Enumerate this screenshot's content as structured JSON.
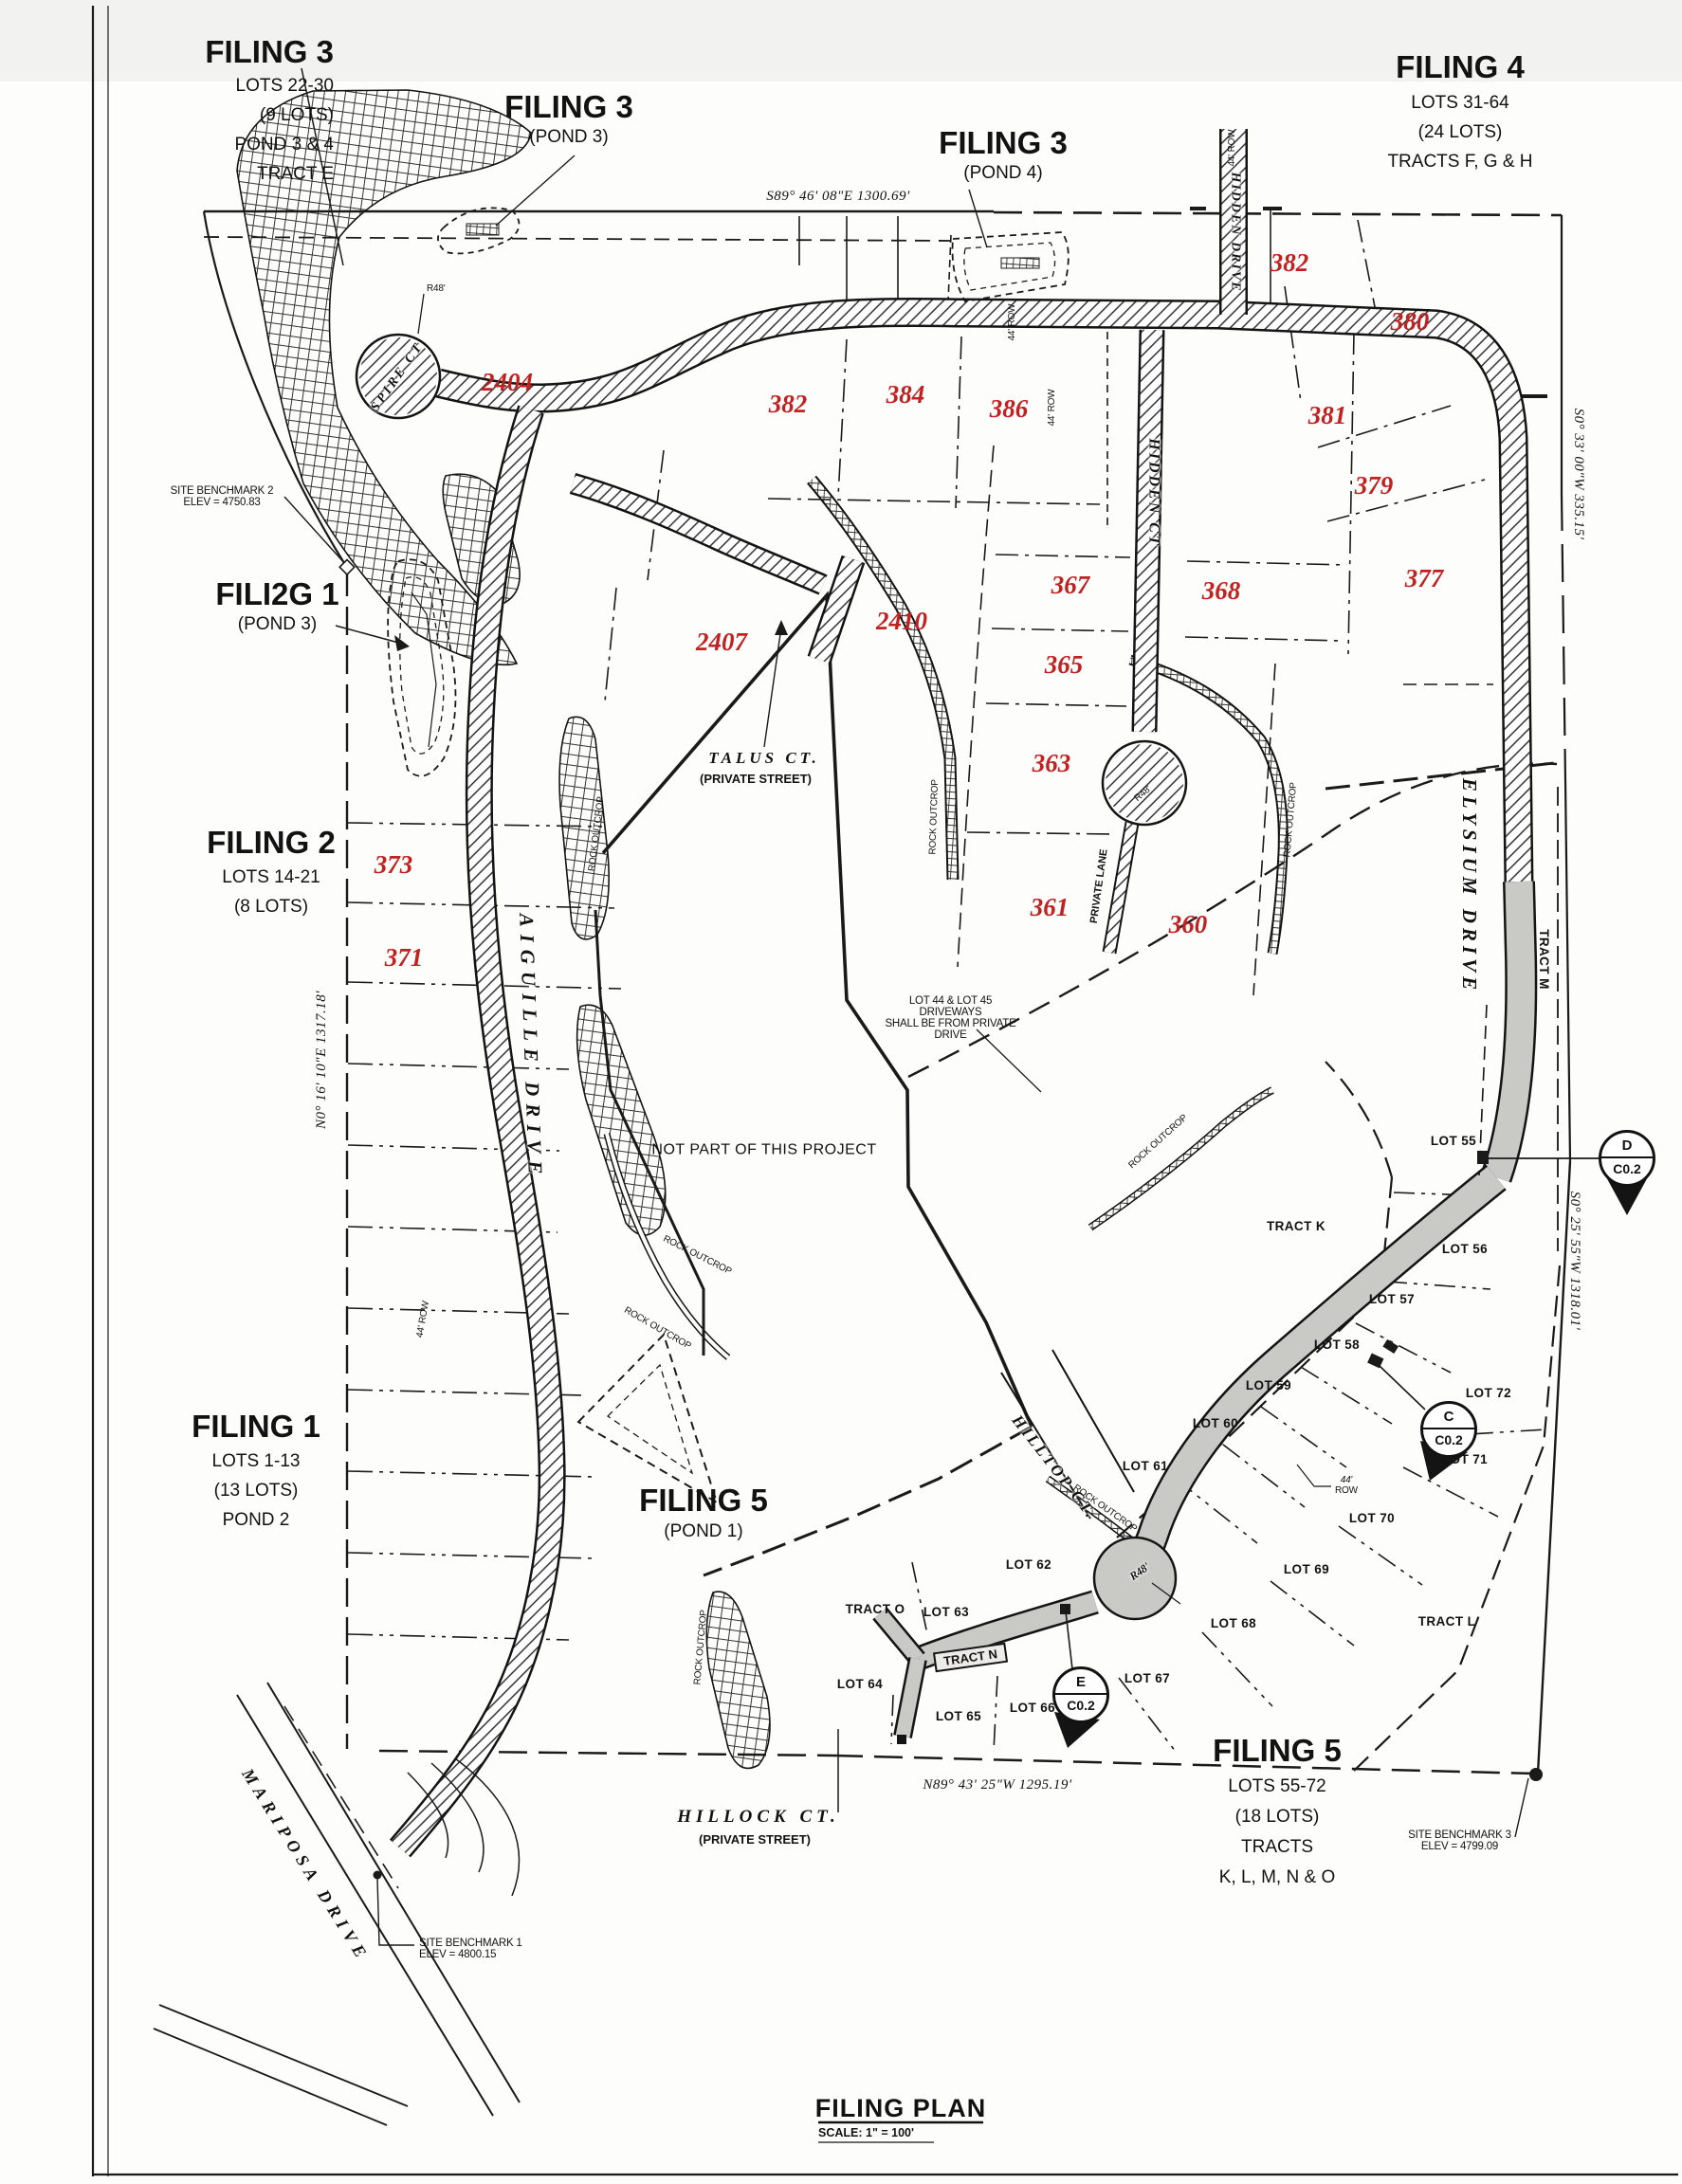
{
  "title_block": {
    "title": "FILING PLAN",
    "scale": "SCALE: 1\" = 100'"
  },
  "filings": {
    "f3nw": {
      "title": "FILING 3",
      "l1": "LOTS 22-30",
      "l2": "(9 LOTS)",
      "l3": "POND 3 & 4",
      "l4": "TRACT E"
    },
    "f3p3": {
      "title": "FILING 3",
      "sub": "(POND 3)"
    },
    "f3p4": {
      "title": "FILING 3",
      "sub": "(POND 4)"
    },
    "f4": {
      "title": "FILING 4",
      "l1": "LOTS 31-64",
      "l2": "(24 LOTS)",
      "l3": "TRACTS F, G & H"
    },
    "f1p3": {
      "title": "FILI2G 1",
      "sub": "(POND 3)"
    },
    "f2": {
      "title": "FILING 2",
      "l1": "LOTS 14-21",
      "l2": "(8 LOTS)"
    },
    "f1": {
      "title": "FILING 1",
      "l1": "LOTS 1-13",
      "l2": "(13 LOTS)",
      "l3": "POND 2"
    },
    "f5p1": {
      "title": "FILING 5",
      "sub": "(POND 1)"
    },
    "f5": {
      "title": "FILING 5",
      "l1": "LOTS 55-72",
      "l2": "(18 LOTS)",
      "l3": "TRACTS",
      "l4": "K, L, M, N & O"
    }
  },
  "streets": {
    "spire": "SPIRE CT",
    "talus": "TALUS CT.",
    "talus_sub": "(PRIVATE STREET)",
    "aiguille": "AIGUILLE DRIVE",
    "hidden_ct": "HIDDEN CT",
    "hidden_drive": "HIDDEN DRIVE",
    "private_lane": "PRIVATE LANE",
    "elysium": "ELYSIUM DRIVE",
    "hilltop": "HILLTOP CT.",
    "hillock": "HILLOCK CT.",
    "hillock_sub": "(PRIVATE STREET)",
    "mariposa": "MARIPOSA DRIVE"
  },
  "bearings": {
    "north": "S89° 46' 08\"E  1300.69'",
    "east_upper": "S0° 33' 00\"W  335.15'",
    "east_lower": "S0° 25' 55\"W  1318.01'",
    "south": "N89° 43' 25\"W  1295.19'",
    "west": "N0° 16' 10\"E  1317.18'"
  },
  "benchmarks": {
    "bm1_l1": "SITE BENCHMARK 1",
    "bm1_l2": "ELEV = 4800.15",
    "bm2_l1": "SITE BENCHMARK 2",
    "bm2_l2": "ELEV = 4750.83",
    "bm3_l1": "SITE BENCHMARK 3",
    "bm3_l2": "ELEV = 4799.09"
  },
  "notes": {
    "not_part": "NOT PART OF THIS PROJECT",
    "driveway_l1": "LOT 44 & LOT 45 DRIVEWAYS",
    "driveway_l2": "SHALL BE FROM PRIVATE DRIVE",
    "rock_outcrop": "ROCK OUTCROP",
    "row44": "44' ROW",
    "row44b": "44'",
    "rowword": "ROW",
    "r48": "R48'"
  },
  "parcels": {
    "p2404": "2404",
    "p2407": "2407",
    "p2410": "2410",
    "p382a": "382",
    "p384": "384",
    "p386": "386",
    "p382b": "382",
    "p380": "380",
    "p381": "381",
    "p379": "379",
    "p377": "377",
    "p367": "367",
    "p368": "368",
    "p365": "365",
    "p363": "363",
    "p361": "361",
    "p360": "360",
    "p373": "373",
    "p371": "371"
  },
  "lots": {
    "l55": "LOT 55",
    "l56": "LOT 56",
    "l57": "LOT 57",
    "l58": "LOT 58",
    "l59": "LOT 59",
    "l60": "LOT 60",
    "l61": "LOT 61",
    "l62": "LOT 62",
    "l63": "LOT 63",
    "l64": "LOT 64",
    "l65": "LOT 65",
    "l66": "LOT 66",
    "l67": "LOT 67",
    "l68": "LOT 68",
    "l69": "LOT 69",
    "l70": "LOT 70",
    "l71": "LOT 71",
    "l72": "LOT 72"
  },
  "tracts": {
    "k": "TRACT K",
    "l": "TRACT L",
    "m": "TRACT M",
    "n": "TRACT N",
    "o": "TRACT O"
  },
  "markers": {
    "d_letter": "D",
    "d_code": "C0.2",
    "c_letter": "C",
    "c_code": "C0.2",
    "e_letter": "E",
    "e_code": "C0.2"
  }
}
